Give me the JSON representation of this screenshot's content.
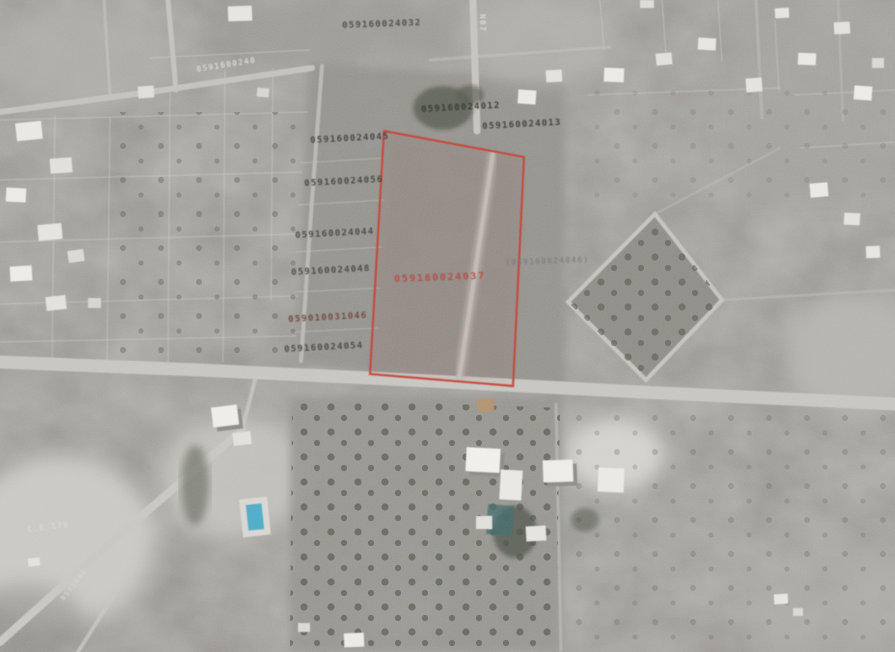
{
  "map": {
    "highlight_color": "#cf4338",
    "highlighted_parcel": {
      "code": "059160024037",
      "points": "384,131 524,157 513,386 370,374"
    },
    "labels": [
      {
        "text": "059160024032",
        "x": 342,
        "y": 22,
        "rot": -2,
        "color": "#4a4944",
        "size": 9
      },
      {
        "text": "0591600240",
        "x": 196,
        "y": 66,
        "rot": -9,
        "color": "#e9e8e4",
        "size": 8,
        "cls": "faint"
      },
      {
        "text": "059160024045",
        "x": 310,
        "y": 137,
        "rot": -3,
        "color": "#403f3a",
        "size": 9
      },
      {
        "text": "059160024056",
        "x": 304,
        "y": 180,
        "rot": -3,
        "color": "#403f3a",
        "size": 9
      },
      {
        "text": "059160024044",
        "x": 295,
        "y": 232,
        "rot": -3,
        "color": "#454440",
        "size": 9
      },
      {
        "text": "059160024048",
        "x": 291,
        "y": 269,
        "rot": -3,
        "color": "#454440",
        "size": 9
      },
      {
        "text": "059010031046",
        "x": 288,
        "y": 316,
        "rot": -3,
        "color": "#71443c",
        "size": 9
      },
      {
        "text": "059160024054",
        "x": 284,
        "y": 346,
        "rot": -3,
        "color": "#454440",
        "size": 9
      },
      {
        "text": "059160024012",
        "x": 421,
        "y": 106,
        "rot": -3,
        "color": "#36352f",
        "size": 9
      },
      {
        "text": "059160024013",
        "x": 482,
        "y": 123,
        "rot": -3,
        "color": "#3b3a34",
        "size": 9
      },
      {
        "text": "059160024037",
        "x": 394,
        "y": 275,
        "rot": -2,
        "color": "#c4473c",
        "size": 10,
        "cls": "red"
      },
      {
        "text": "(059160024046)",
        "x": 505,
        "y": 259,
        "rot": -2,
        "color": "#7d7c76",
        "size": 8,
        "cls": "faint"
      },
      {
        "text": "N07",
        "x": 486,
        "y": 14,
        "rot": 90,
        "color": "#eae9e5",
        "size": 8,
        "cls": "faint"
      },
      {
        "text": "C.E.170",
        "x": 27,
        "y": 526,
        "rot": -7,
        "color": "#dfdeda",
        "size": 8,
        "cls": "faint"
      },
      {
        "text": "0591600",
        "x": 60,
        "y": 598,
        "rot": -52,
        "color": "#dbdad6",
        "size": 7,
        "cls": "faint"
      }
    ]
  }
}
